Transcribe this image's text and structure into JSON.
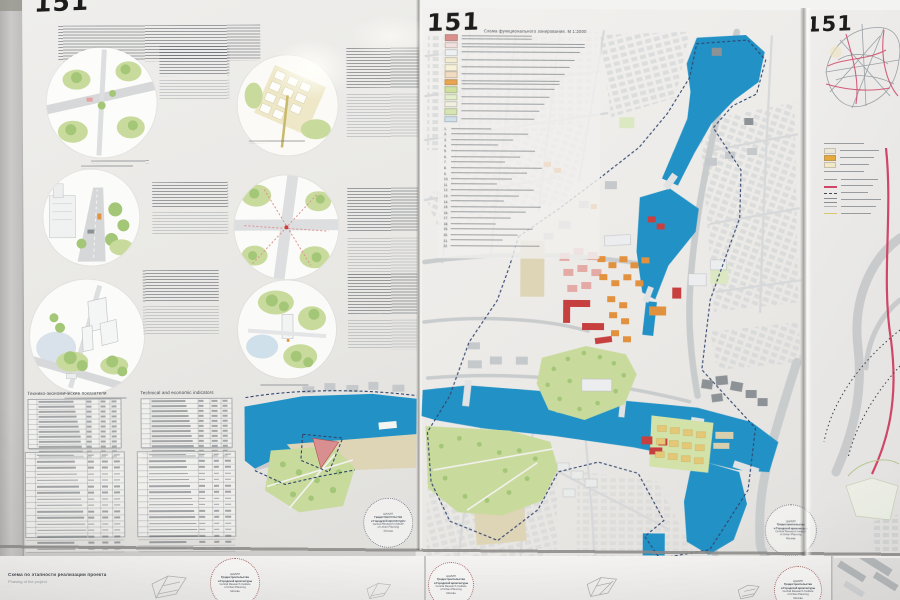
{
  "palette": {
    "wall": "#cfcecc",
    "board": "#ecebe8",
    "water": "#2292c6",
    "green_park": "#c9da9d",
    "green_tree": "#a3c677",
    "orange": "#e2913f",
    "red": "#c64040",
    "pink": "#e4aaa5",
    "yellow": "#e4c878",
    "beige": "#ded4b6",
    "gray_building": "#c6c9cb",
    "dark_gray": "#8d9296",
    "road": "#c9cccd",
    "boundary": "#31456e",
    "route_red": "#cf4668"
  },
  "panels": {
    "left": {
      "number": "151",
      "tables": {
        "title_ru": "Технико-экономические показатели",
        "title_en": "Technical and economic indicators"
      }
    },
    "center": {
      "number": "151",
      "map_title": "Схема функционального зонирования. М 1:2000",
      "legend_swatches": [
        "#d98f8c",
        "#f2e0de",
        "#eef1f2",
        "#f2ecd0",
        "#f6f0d6",
        "#f2dcc1",
        "#eaa44d",
        "#cfe09e",
        "#e4eecb",
        "#f1f0e0",
        "#d6e5b2",
        "#cfe0ea"
      ],
      "index_count": 22
    },
    "right": {
      "number": "151",
      "legend_items": [
        {
          "kind": "heading"
        },
        {
          "kind": "swatch",
          "color": "#ece6d6"
        },
        {
          "kind": "swatch",
          "color": "#e5a93e"
        },
        {
          "kind": "swatch",
          "color": "#f1e8c8"
        },
        {
          "kind": "heading"
        },
        {
          "kind": "line",
          "color": "#9a9da0",
          "w": 1.5
        },
        {
          "kind": "line",
          "color": "#cf4668",
          "w": 2.5
        },
        {
          "kind": "line",
          "color": "#44474c",
          "w": 1,
          "dash": true
        },
        {
          "kind": "line",
          "color": "#8a8d90",
          "w": 1,
          "double": true
        },
        {
          "kind": "line",
          "color": "#b0b3b6",
          "w": 1
        },
        {
          "kind": "line",
          "color": "#d9c56a",
          "w": 1.5
        }
      ]
    }
  },
  "stamp": {
    "lines": [
      "ЦНИИП",
      "Градостроительства",
      "и Городской архитектуры",
      "Central Research Institute",
      "of Urban Planning",
      "Москва"
    ]
  },
  "bottom": {
    "caption_ru": "Схема по этапности реализации проекта",
    "caption_en": "Phasing of the project"
  }
}
